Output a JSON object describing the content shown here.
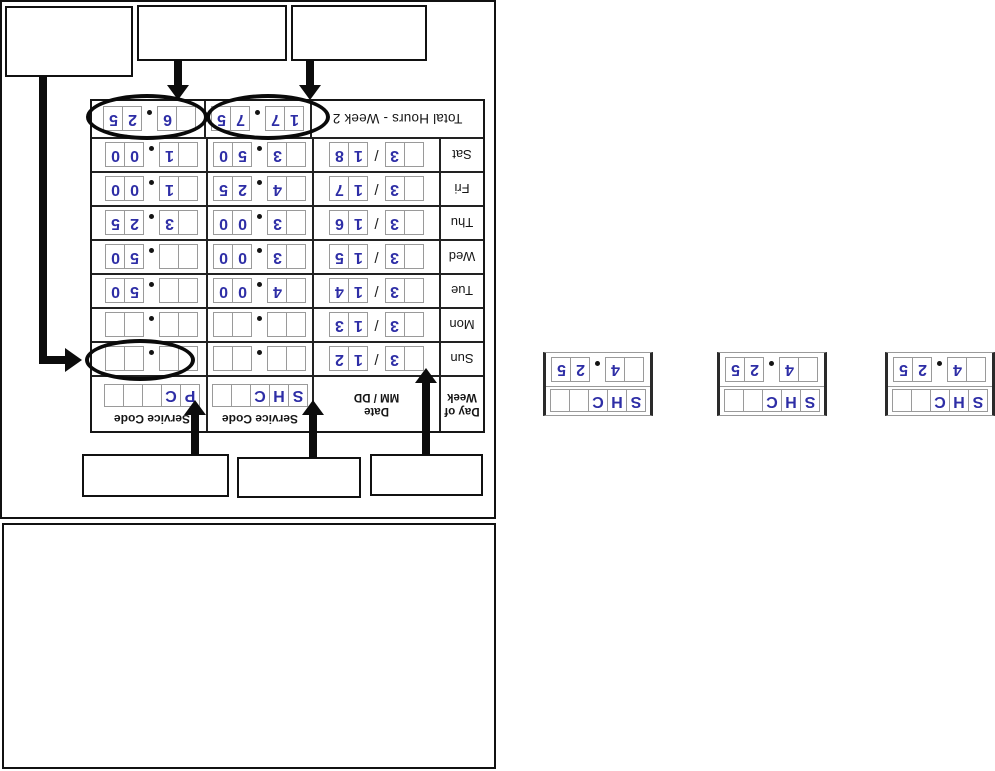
{
  "colors": {
    "ink": "#2e2ea6",
    "line": "#111111",
    "box_border": "#9a9a9a"
  },
  "timesheet": {
    "total_label": "Total Hours - Week 2",
    "day_header": [
      "Day of",
      "Week"
    ],
    "date_header": [
      "Date",
      "MM / DD"
    ],
    "service_header": "Service Code",
    "date_slash": "/",
    "codes": {
      "shc": [
        "S",
        "H",
        "C",
        "",
        ""
      ],
      "pc": [
        "P",
        "C",
        "",
        "",
        ""
      ]
    },
    "rows": [
      {
        "day": "Sun",
        "mm": [
          "",
          "3"
        ],
        "dd": [
          "1",
          "2"
        ],
        "shc": [
          "",
          "",
          "",
          ""
        ],
        "pc": [
          "",
          "",
          "",
          ""
        ]
      },
      {
        "day": "Mon",
        "mm": [
          "",
          "3"
        ],
        "dd": [
          "1",
          "3"
        ],
        "shc": [
          "",
          "",
          "",
          ""
        ],
        "pc": [
          "",
          "",
          "",
          ""
        ]
      },
      {
        "day": "Tue",
        "mm": [
          "",
          "3"
        ],
        "dd": [
          "1",
          "4"
        ],
        "shc": [
          "",
          "4",
          "0",
          "0"
        ],
        "pc": [
          "",
          "",
          "5",
          "0"
        ]
      },
      {
        "day": "Wed",
        "mm": [
          "",
          "3"
        ],
        "dd": [
          "1",
          "5"
        ],
        "shc": [
          "",
          "3",
          "0",
          "0"
        ],
        "pc": [
          "",
          "",
          "5",
          "0"
        ]
      },
      {
        "day": "Thu",
        "mm": [
          "",
          "3"
        ],
        "dd": [
          "1",
          "6"
        ],
        "shc": [
          "",
          "3",
          "0",
          "0"
        ],
        "pc": [
          "",
          "3",
          "2",
          "5"
        ]
      },
      {
        "day": "Fri",
        "mm": [
          "",
          "3"
        ],
        "dd": [
          "1",
          "7"
        ],
        "shc": [
          "",
          "4",
          "2",
          "5"
        ],
        "pc": [
          "",
          "1",
          "0",
          "0"
        ]
      },
      {
        "day": "Sat",
        "mm": [
          "",
          "3"
        ],
        "dd": [
          "1",
          "8"
        ],
        "shc": [
          "",
          "3",
          "5",
          "0"
        ],
        "pc": [
          "",
          "1",
          "0",
          "0"
        ]
      }
    ],
    "totals": {
      "shc": [
        "1",
        "7",
        "7",
        "5"
      ],
      "pc": [
        "",
        "6",
        "2",
        "5"
      ]
    }
  },
  "examples": [
    {
      "code": [
        "S",
        "H",
        "C",
        "",
        ""
      ],
      "value": [
        "",
        "4",
        "2",
        "5"
      ]
    },
    {
      "code": [
        "S",
        "H",
        "C",
        "",
        ""
      ],
      "value": [
        "",
        "4",
        "2",
        "5"
      ]
    },
    {
      "code": [
        "S",
        "H",
        "C",
        "",
        ""
      ],
      "value": [
        "",
        "4",
        "2",
        "5"
      ]
    }
  ]
}
